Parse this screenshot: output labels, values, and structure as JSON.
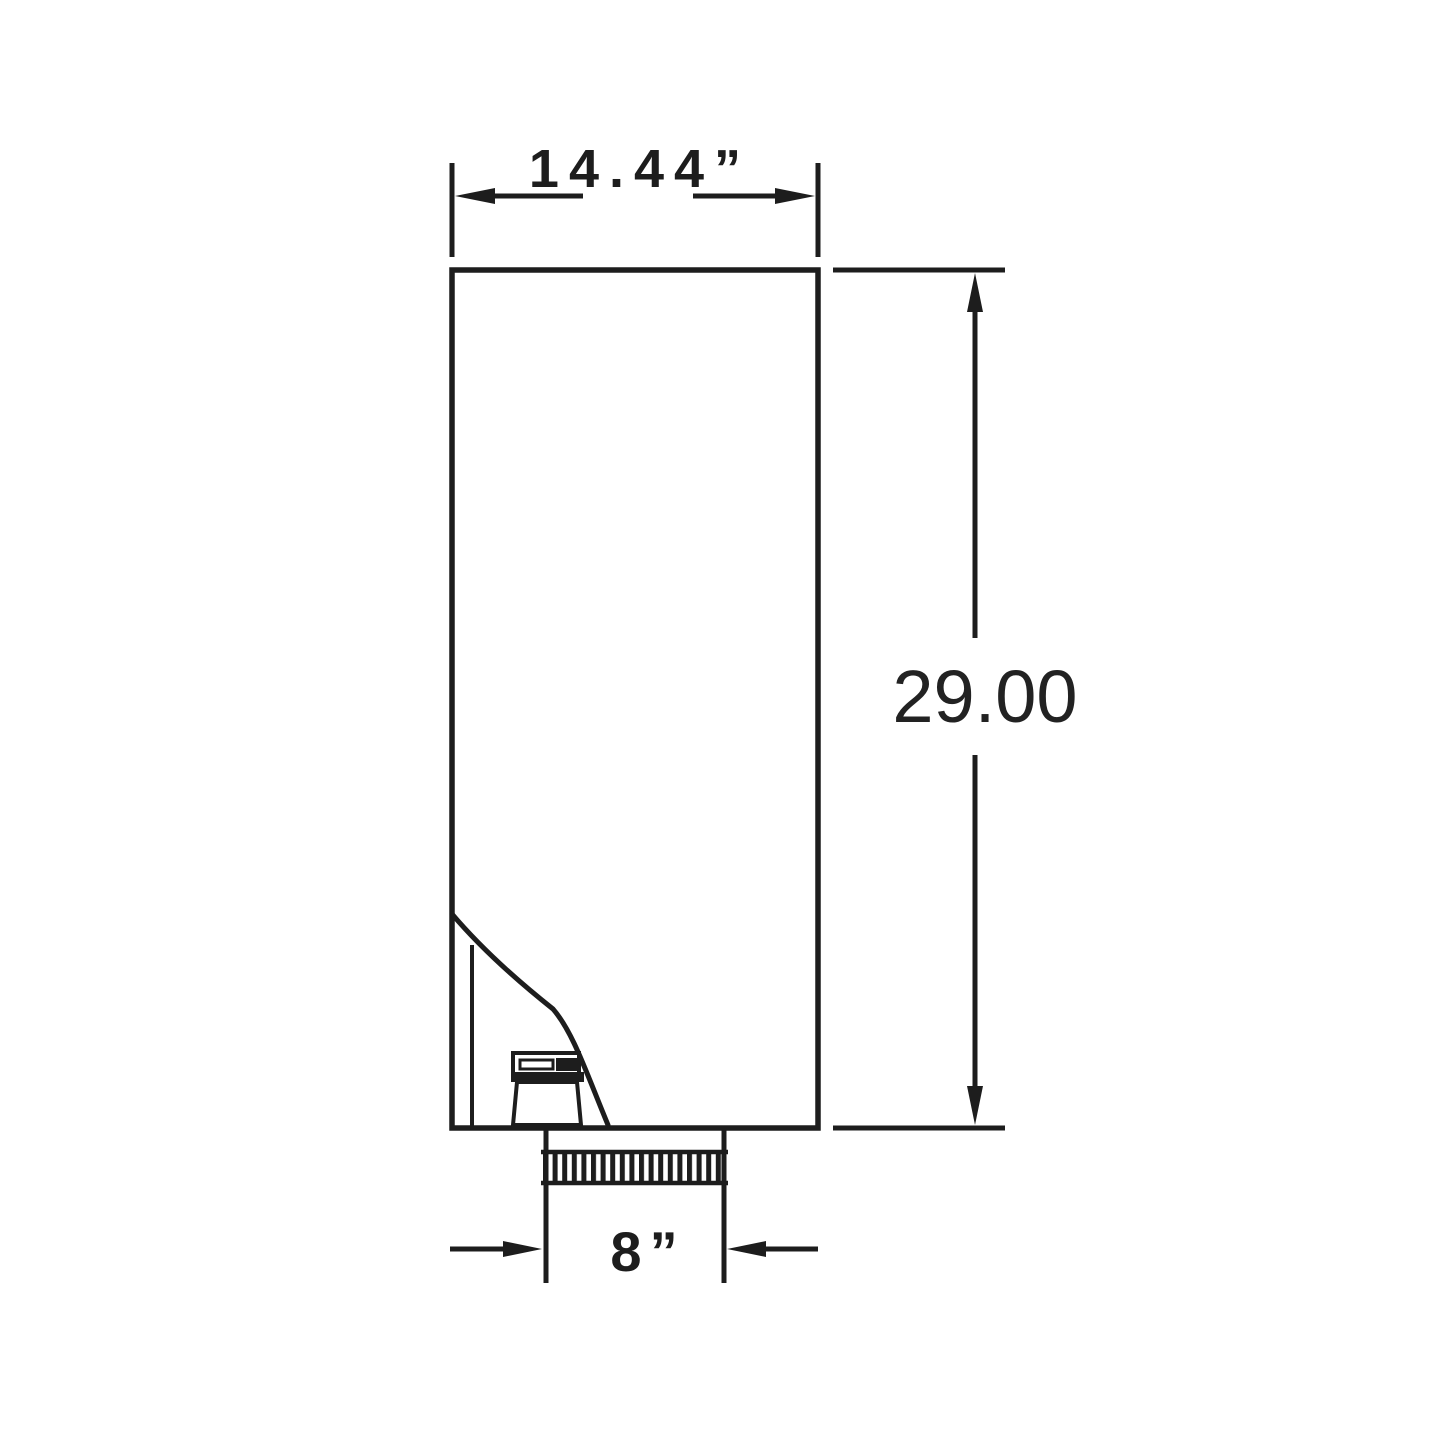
{
  "diagram": {
    "type": "technical-dimension-drawing",
    "background_color": "#ffffff",
    "line_color": "#1d1d1d",
    "dimensions": {
      "width": {
        "label": "14.44”"
      },
      "height": {
        "label": "29.00"
      },
      "duct_diameter": {
        "label": "8”"
      }
    }
  }
}
